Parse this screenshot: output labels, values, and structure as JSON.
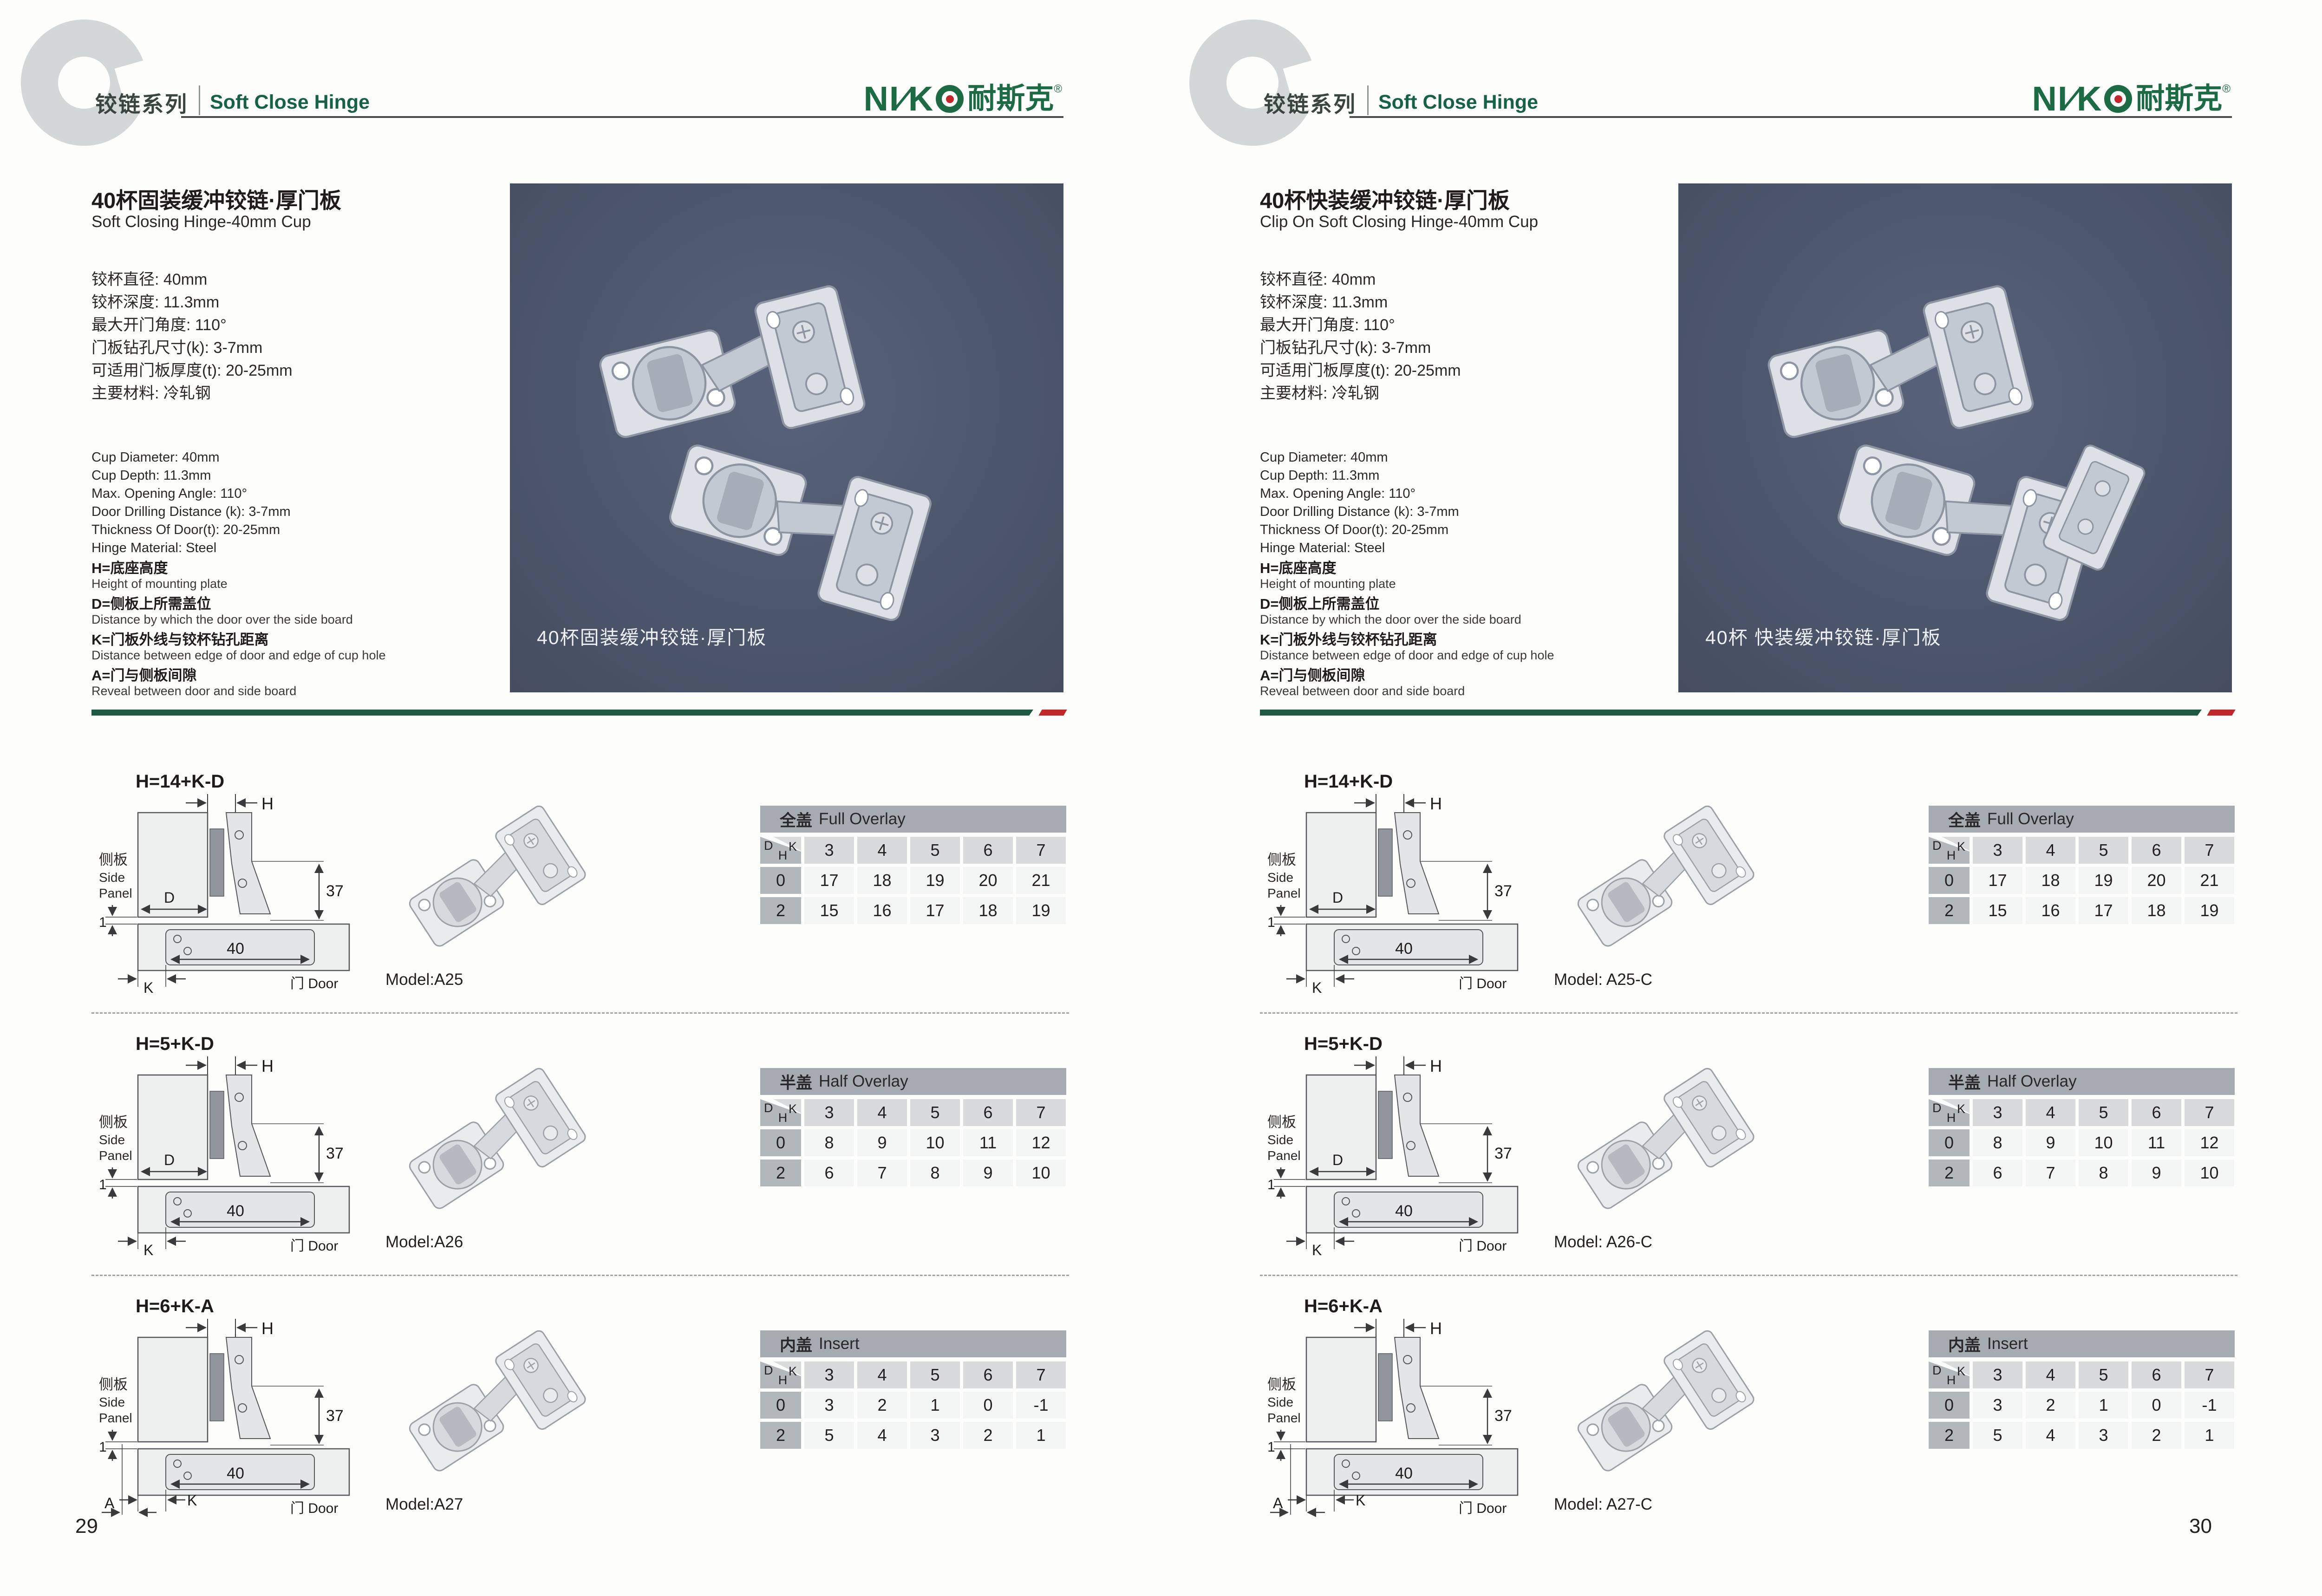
{
  "logo": {
    "part1": "NI",
    "slash": "∕",
    "part2": "K",
    "cn": "耐斯克",
    "reg": "®"
  },
  "table_corner": {
    "d": "D",
    "k": "K",
    "h": "H"
  },
  "diagram": {
    "side_panel_cn": "侧板",
    "side_panel_en_1": "Side",
    "side_panel_en_2": "Panel",
    "door": "门 Door",
    "dim_37": "37",
    "dim_40": "40",
    "dim_1": "1",
    "h": "H",
    "d": "D",
    "k": "K",
    "a": "A"
  },
  "pages": [
    {
      "series_cn": "铰链系列",
      "series_en": "Soft Close Hinge",
      "title_cn": "40杯固装缓冲铰链·厚门板",
      "title_en": "Soft Closing Hinge-40mm Cup",
      "specs_cn": [
        "铰杯直径: 40mm",
        "铰杯深度: 11.3mm",
        "最大开门角度: 110°",
        "门板钻孔尺寸(k): 3-7mm",
        "可适用门板厚度(t): 20-25mm",
        "主要材料: 冷轧钢"
      ],
      "specs_en": [
        "Cup Diameter: 40mm",
        "Cup Depth: 11.3mm",
        "Max. Opening Angle: 110°",
        "Door Drilling Distance (k): 3-7mm",
        "Thickness Of Door(t): 20-25mm",
        "Hinge Material: Steel"
      ],
      "legend": [
        {
          "cn": "H=底座高度",
          "en": "Height of mounting plate"
        },
        {
          "cn": "D=侧板上所需盖位",
          "en": "Distance by which the door over the side board"
        },
        {
          "cn": "K=门板外线与铰杯钻孔距离",
          "en": "Distance between edge of door and edge of cup hole"
        },
        {
          "cn": "A=门与侧板间隙",
          "en": "Reveal between door and side board"
        }
      ],
      "photo_caption": "40杯固装缓冲铰链·厚门板",
      "page_number": "29",
      "rows": [
        {
          "formula": "H=14+K-D",
          "diagram_variant": "D",
          "model": "Model:A25",
          "table": {
            "title_cn": "全盖",
            "title_en": "Full Overlay",
            "k_values": [
              "3",
              "4",
              "5",
              "6",
              "7"
            ],
            "rows": [
              {
                "h": "0",
                "values": [
                  "17",
                  "18",
                  "19",
                  "20",
                  "21"
                ]
              },
              {
                "h": "2",
                "values": [
                  "15",
                  "16",
                  "17",
                  "18",
                  "19"
                ]
              }
            ]
          }
        },
        {
          "formula": "H=5+K-D",
          "diagram_variant": "D",
          "model": "Model:A26",
          "table": {
            "title_cn": "半盖",
            "title_en": "Half Overlay",
            "k_values": [
              "3",
              "4",
              "5",
              "6",
              "7"
            ],
            "rows": [
              {
                "h": "0",
                "values": [
                  "8",
                  "9",
                  "10",
                  "11",
                  "12"
                ]
              },
              {
                "h": "2",
                "values": [
                  "6",
                  "7",
                  "8",
                  "9",
                  "10"
                ]
              }
            ]
          }
        },
        {
          "formula": "H=6+K-A",
          "diagram_variant": "A",
          "model": "Model:A27",
          "table": {
            "title_cn": "内盖",
            "title_en": "Insert",
            "k_values": [
              "3",
              "4",
              "5",
              "6",
              "7"
            ],
            "rows": [
              {
                "h": "0",
                "values": [
                  "3",
                  "2",
                  "1",
                  "0",
                  "-1"
                ]
              },
              {
                "h": "2",
                "values": [
                  "5",
                  "4",
                  "3",
                  "2",
                  "1"
                ]
              }
            ]
          }
        }
      ]
    },
    {
      "series_cn": "铰链系列",
      "series_en": "Soft Close Hinge",
      "title_cn": "40杯快装缓冲铰链·厚门板",
      "title_en": "Clip On Soft Closing Hinge-40mm Cup",
      "specs_cn": [
        "铰杯直径: 40mm",
        "铰杯深度: 11.3mm",
        "最大开门角度: 110°",
        "门板钻孔尺寸(k): 3-7mm",
        "可适用门板厚度(t): 20-25mm",
        "主要材料: 冷轧钢"
      ],
      "specs_en": [
        "Cup Diameter: 40mm",
        "Cup Depth: 11.3mm",
        "Max. Opening Angle: 110°",
        "Door Drilling Distance (k): 3-7mm",
        "Thickness Of Door(t): 20-25mm",
        "Hinge Material: Steel"
      ],
      "legend": [
        {
          "cn": "H=底座高度",
          "en": "Height of mounting plate"
        },
        {
          "cn": "D=侧板上所需盖位",
          "en": "Distance by which the door over the side board"
        },
        {
          "cn": "K=门板外线与铰杯钻孔距离",
          "en": "Distance between edge of door and edge of cup hole"
        },
        {
          "cn": "A=门与侧板间隙",
          "en": "Reveal between door and side board"
        }
      ],
      "photo_caption": "40杯 快装缓冲铰链·厚门板",
      "page_number": "30",
      "rows": [
        {
          "formula": "H=14+K-D",
          "diagram_variant": "D",
          "model": "Model: A25-C",
          "table": {
            "title_cn": "全盖",
            "title_en": "Full Overlay",
            "k_values": [
              "3",
              "4",
              "5",
              "6",
              "7"
            ],
            "rows": [
              {
                "h": "0",
                "values": [
                  "17",
                  "18",
                  "19",
                  "20",
                  "21"
                ]
              },
              {
                "h": "2",
                "values": [
                  "15",
                  "16",
                  "17",
                  "18",
                  "19"
                ]
              }
            ]
          }
        },
        {
          "formula": "H=5+K-D",
          "diagram_variant": "D",
          "model": "Model: A26-C",
          "table": {
            "title_cn": "半盖",
            "title_en": "Half Overlay",
            "k_values": [
              "3",
              "4",
              "5",
              "6",
              "7"
            ],
            "rows": [
              {
                "h": "0",
                "values": [
                  "8",
                  "9",
                  "10",
                  "11",
                  "12"
                ]
              },
              {
                "h": "2",
                "values": [
                  "6",
                  "7",
                  "8",
                  "9",
                  "10"
                ]
              }
            ]
          }
        },
        {
          "formula": "H=6+K-A",
          "diagram_variant": "A",
          "model": "Model: A27-C",
          "table": {
            "title_cn": "内盖",
            "title_en": "Insert",
            "k_values": [
              "3",
              "4",
              "5",
              "6",
              "7"
            ],
            "rows": [
              {
                "h": "0",
                "values": [
                  "3",
                  "2",
                  "1",
                  "0",
                  "-1"
                ]
              },
              {
                "h": "2",
                "values": [
                  "5",
                  "4",
                  "3",
                  "2",
                  "1"
                ]
              }
            ]
          }
        }
      ]
    }
  ]
}
